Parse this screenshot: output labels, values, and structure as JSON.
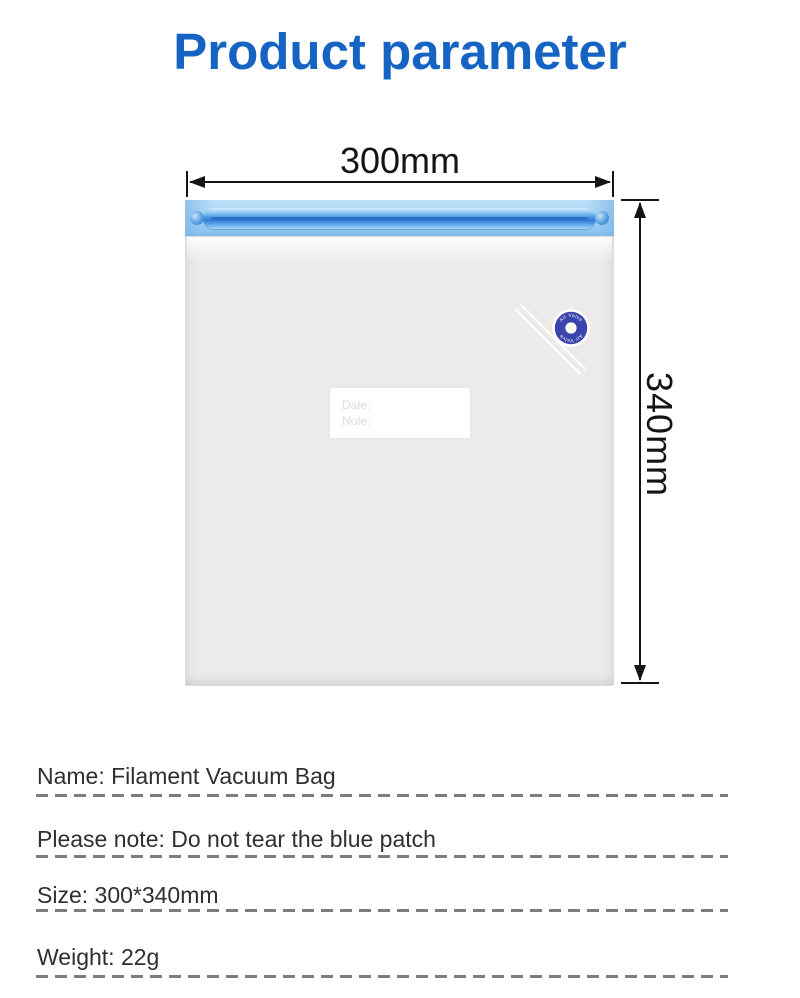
{
  "title": {
    "text": "Product parameter",
    "color": "#1564c4"
  },
  "product": {
    "name": "Filament Vacuum Bag",
    "width_label": "300mm",
    "height_label": "340mm",
    "valve_label": "Air Valve",
    "tag_line1": "Date:",
    "tag_line2": "Note:",
    "colors": {
      "zipper_band_blue": "#a6d4f3",
      "zipper_bar_blue": "#2f7cd6",
      "valve_blue": "#3a46ae",
      "bag_body_gray": "#ecebe9",
      "dimension_ink": "#141414",
      "dash_gray": "#7d7d7d"
    }
  },
  "specs": [
    "Name: Filament Vacuum Bag",
    "Please note: Do not tear the blue patch",
    "Size: 300*340mm",
    "Weight: 22g"
  ]
}
